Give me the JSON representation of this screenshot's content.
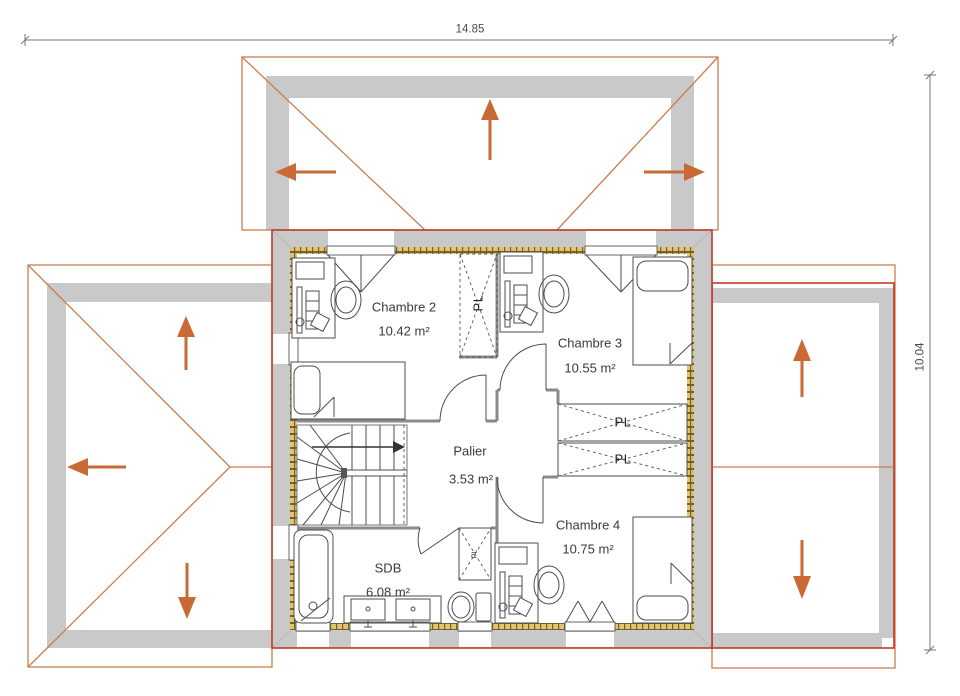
{
  "dimensions": {
    "width": "14.85",
    "height": "10.04"
  },
  "rooms": [
    {
      "name": "Chambre 2",
      "area": "10.42 m²"
    },
    {
      "name": "Chambre 3",
      "area": "10.55 m²"
    },
    {
      "name": "Chambre 4",
      "area": "10.75 m²"
    },
    {
      "name": "Palier",
      "area": "3.53 m²"
    },
    {
      "name": "SDB",
      "area": "6.08 m²"
    }
  ],
  "closets": {
    "top": "PL",
    "middle_upper": "PL",
    "middle_lower": "PL",
    "bathroom": "PL"
  },
  "colors": {
    "roof_outline": "#c97e4f",
    "building_outline": "#c03a2b",
    "arrow": "#c96a35",
    "roof_band": "#c9c9c9",
    "wall_fill": "#e5c36c",
    "interior_wall": "#8a8a8a",
    "furniture": "#4d4d4d",
    "dimension": "#777777"
  }
}
